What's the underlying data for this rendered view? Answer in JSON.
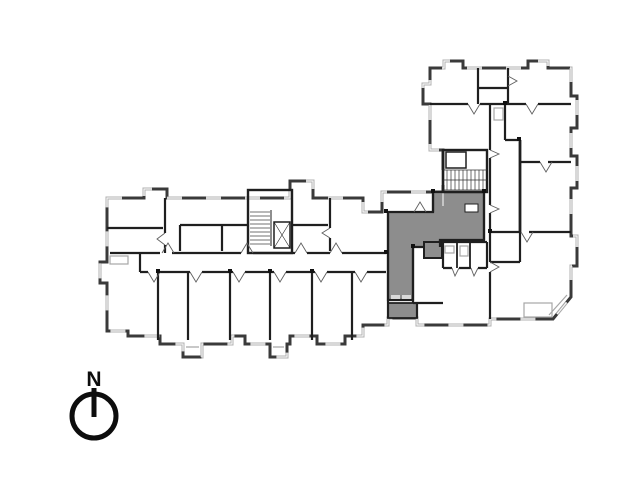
{
  "plan": {
    "kind": "architectural-floor-plan",
    "compass": {
      "label": "N"
    },
    "colors": {
      "background": "#ffffff",
      "outer_wall": "#3a3a3a",
      "inner_wall": "#1f1f1f",
      "window_band": "#b0b0b0",
      "glazing": "#ffffff",
      "highlight_fill": "#8d8d8d",
      "door_line": "#5f5f5f",
      "light_detail": "#a6a6a6",
      "compass": "#0d0d0d"
    },
    "highlighted_unit": {
      "main_points": "388,212 433,212 433,192 484,192 484,240 440,240 440,247 413,247 413,300 388,300",
      "annex_points": "388,303 417,303 417,318 388,318"
    }
  }
}
